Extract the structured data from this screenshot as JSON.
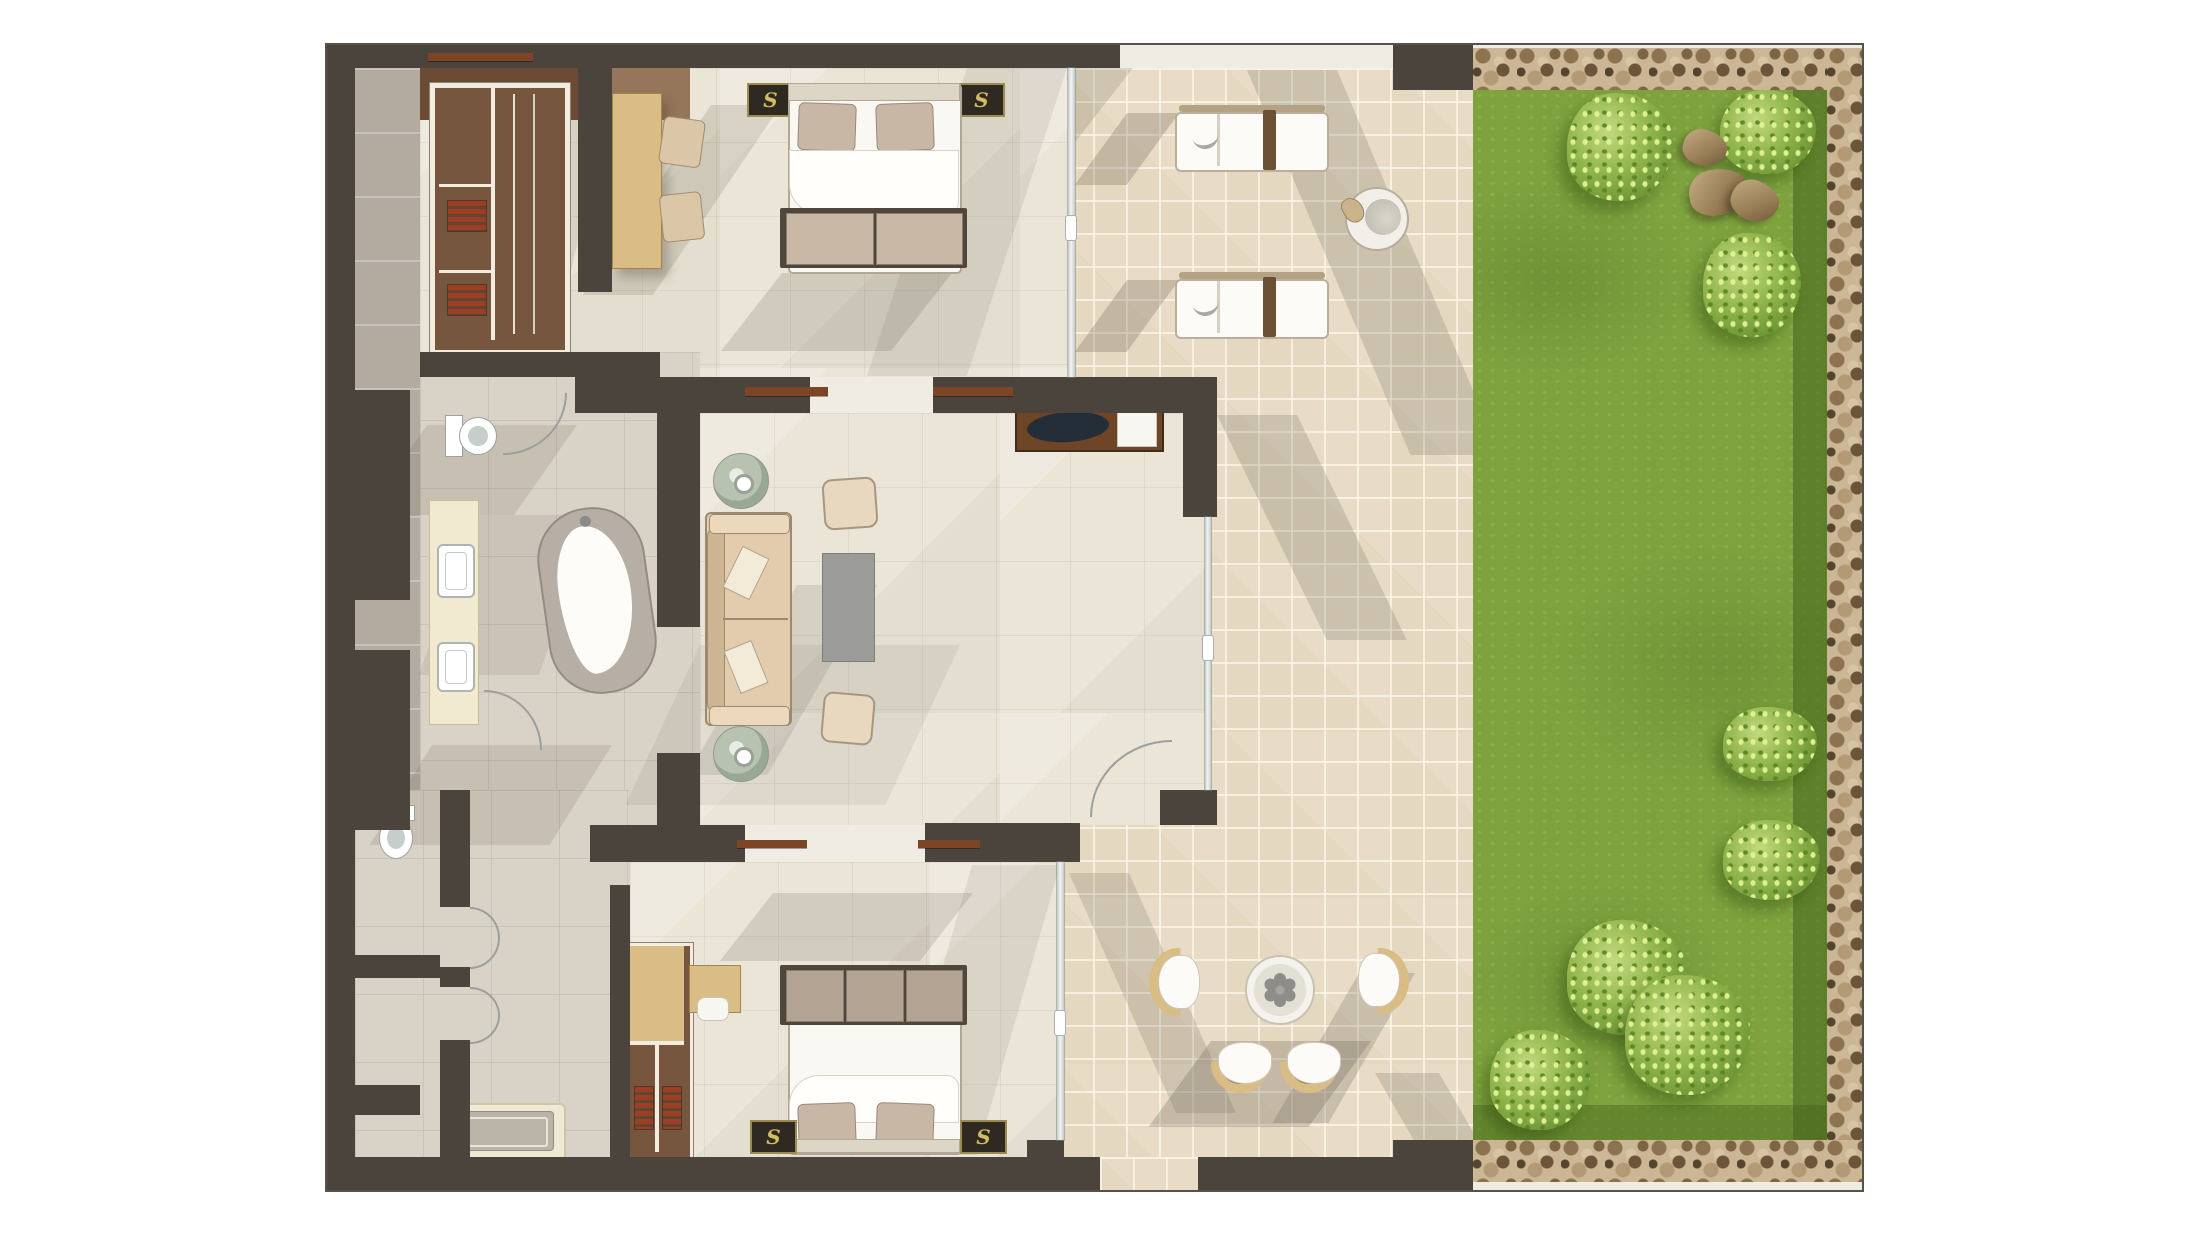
{
  "document": {
    "type": "rendered-floor-plan",
    "description": "Top-down color rendering of a two-bedroom suite with bathrooms, living room, tiled patio with sun loungers and dining set, lawn garden with bushes and rocks, pebble border"
  },
  "markers": {
    "nightstand_monogram": "S"
  },
  "palette": {
    "wall": "#4a443c",
    "lintel": "#7c4526",
    "floorCream": "#ebe5d8",
    "floorGray": "#d9d2c6",
    "strip": "#b3aba0",
    "patio": "#e8dcc6",
    "lawn": "#7da23e",
    "pebbleBg": "#cbb795",
    "pebble": "#8d7250",
    "bedWhite": "#faf8f3",
    "pillow": "#c9b7a5",
    "benchDark": "#4f463c",
    "markerBg": "#2f2a21",
    "gold": "#d4bc62",
    "red": "#9c3d24",
    "tan2": "#d9bd85",
    "vanity": "#f1ead0",
    "tableGray": "#9b9b99"
  },
  "legend": {
    "rooms": [
      {
        "id": "bedroom-1",
        "furniture": [
          "double-bed",
          "nightstand-left",
          "nightstand-right",
          "bench",
          "wardrobe",
          "upper-cabinet",
          "desk",
          "chairs"
        ]
      },
      {
        "id": "living-room",
        "furniture": [
          "sofa",
          "throw-pillows",
          "ottoman-poufs",
          "coffee-table",
          "potted-plants",
          "tv-console",
          "tv"
        ]
      },
      {
        "id": "wc",
        "furniture": [
          "toilet",
          "door"
        ]
      },
      {
        "id": "bathroom-1",
        "furniture": [
          "vanity-two-sinks",
          "freestanding-bathtub",
          "door"
        ]
      },
      {
        "id": "bathroom-2",
        "furniture": [
          "toilet",
          "shower-tray",
          "doors"
        ]
      },
      {
        "id": "bedroom-2",
        "furniture": [
          "double-bed",
          "nightstand-left",
          "nightstand-right",
          "bench",
          "wardrobe",
          "desk"
        ]
      },
      {
        "id": "patio",
        "furniture": [
          "sun-lounger",
          "sun-lounger",
          "side-table",
          "dining-table",
          "dining-chairs-4"
        ]
      },
      {
        "id": "garden",
        "furniture": [
          "lawn",
          "bushes",
          "rocks",
          "pebble-border"
        ]
      }
    ]
  },
  "garden": {
    "bushes": [
      {
        "x": 94,
        "y": 3,
        "w": 106,
        "h": 108
      },
      {
        "x": 247,
        "y": 0,
        "w": 96,
        "h": 84
      },
      {
        "x": 230,
        "y": 143,
        "w": 98,
        "h": 104
      },
      {
        "x": 250,
        "y": 617,
        "w": 94,
        "h": 74
      },
      {
        "x": 250,
        "y": 730,
        "w": 97,
        "h": 80
      },
      {
        "x": 94,
        "y": 830,
        "w": 120,
        "h": 115
      },
      {
        "x": 152,
        "y": 885,
        "w": 125,
        "h": 120
      },
      {
        "x": 17,
        "y": 940,
        "w": 100,
        "h": 100
      }
    ],
    "rocks": [
      {
        "x": 210,
        "y": 40,
        "w": 44,
        "h": 36,
        "rot": 15
      },
      {
        "x": 216,
        "y": 79,
        "w": 58,
        "h": 46,
        "rot": -12
      },
      {
        "x": 258,
        "y": 91,
        "w": 48,
        "h": 40,
        "rot": 22
      }
    ]
  },
  "shadows": {
    "patio": [
      {
        "x": 13,
        "y": 0,
        "w": 60,
        "h": 120,
        "skew": -38,
        "o": 0.2
      },
      {
        "x": 187,
        "y": 2,
        "w": 90,
        "h": 385,
        "skew": 23,
        "o": 0.22
      },
      {
        "x": 67,
        "y": 45,
        "w": 52,
        "h": 72,
        "skew": -36,
        "o": 0.28
      },
      {
        "x": 67,
        "y": 212,
        "w": 52,
        "h": 72,
        "skew": -36,
        "o": 0.28
      },
      {
        "x": 157,
        "y": 347,
        "w": 80,
        "h": 225,
        "skew": 26,
        "o": 0.22
      },
      {
        "x": 9,
        "y": 805,
        "w": 60,
        "h": 240,
        "skew": 24,
        "o": 0.2
      },
      {
        "x": 151,
        "y": 973,
        "w": 160,
        "h": 86,
        "skew": -36,
        "o": 0.28
      },
      {
        "x": 299,
        "y": 905,
        "w": 56,
        "h": 150,
        "skew": -30,
        "o": 0.24
      },
      {
        "x": 315,
        "y": 1005,
        "w": 64,
        "h": 80,
        "skew": 30,
        "o": 0.22
      }
    ],
    "interior": [
      {
        "x": 384,
        "y": 60,
        "w": 70,
        "h": 190,
        "skew": -34,
        "o": 0.18
      },
      {
        "x": 455,
        "y": 228,
        "w": 170,
        "h": 78,
        "skew": -38,
        "o": 0.2
      },
      {
        "x": 640,
        "y": 23,
        "w": 100,
        "h": 308,
        "skew": -18,
        "o": 0.13
      },
      {
        "x": 470,
        "y": 540,
        "w": 80,
        "h": 190,
        "skew": -30,
        "o": 0.16
      },
      {
        "x": 446,
        "y": 848,
        "w": 200,
        "h": 68,
        "skew": -38,
        "o": 0.19
      },
      {
        "x": 645,
        "y": 820,
        "w": 88,
        "h": 290,
        "skew": -16,
        "o": 0.13
      },
      {
        "x": 100,
        "y": 380,
        "w": 150,
        "h": 90,
        "skew": -35,
        "o": 0.17
      },
      {
        "x": 105,
        "y": 700,
        "w": 180,
        "h": 100,
        "skew": -32,
        "o": 0.17
      },
      {
        "x": 150,
        "y": 470,
        "w": 120,
        "h": 160,
        "skew": -20,
        "o": 0.13
      },
      {
        "x": 373,
        "y": 600,
        "w": 260,
        "h": 160,
        "skew": -25,
        "o": 0.1
      },
      {
        "x": 235,
        "y": 60,
        "w": 50,
        "h": 240,
        "skew": -14,
        "o": 0.14
      }
    ]
  }
}
